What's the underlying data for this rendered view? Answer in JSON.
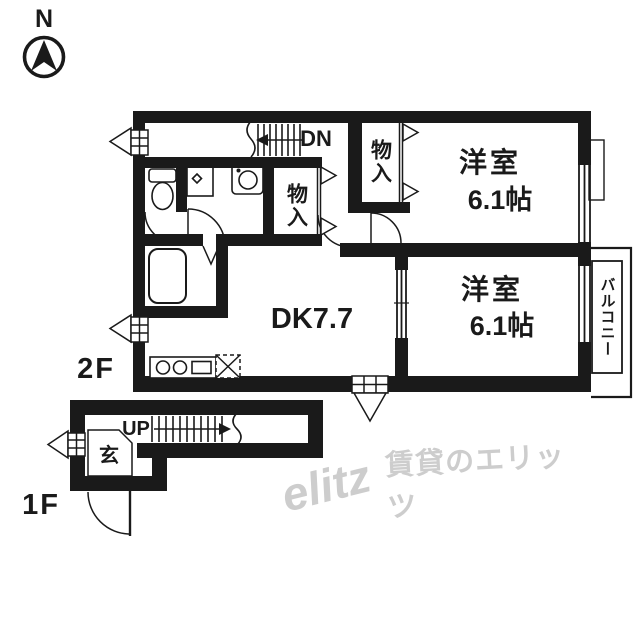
{
  "compass": {
    "north_label": "N"
  },
  "floors": {
    "second_label": "2F",
    "first_label": "1F"
  },
  "stairs": {
    "down_label": "DN",
    "up_label": "UP"
  },
  "rooms": {
    "western_room_1": {
      "name": "洋室",
      "size": "6.1帖"
    },
    "western_room_2": {
      "name": "洋室",
      "size": "6.1帖"
    },
    "dining_kitchen": {
      "label": "DK7.7"
    },
    "closet_1": {
      "label": "物入"
    },
    "closet_2": {
      "label": "物入"
    },
    "entrance": {
      "label": "玄"
    },
    "balcony": {
      "label": "バルコニー"
    }
  },
  "watermark": {
    "logo": "elitz",
    "text": "賃貸のエリッツ",
    "color": "#cdcdcd"
  },
  "colors": {
    "wall": "#1a1a1a",
    "background": "#ffffff"
  }
}
